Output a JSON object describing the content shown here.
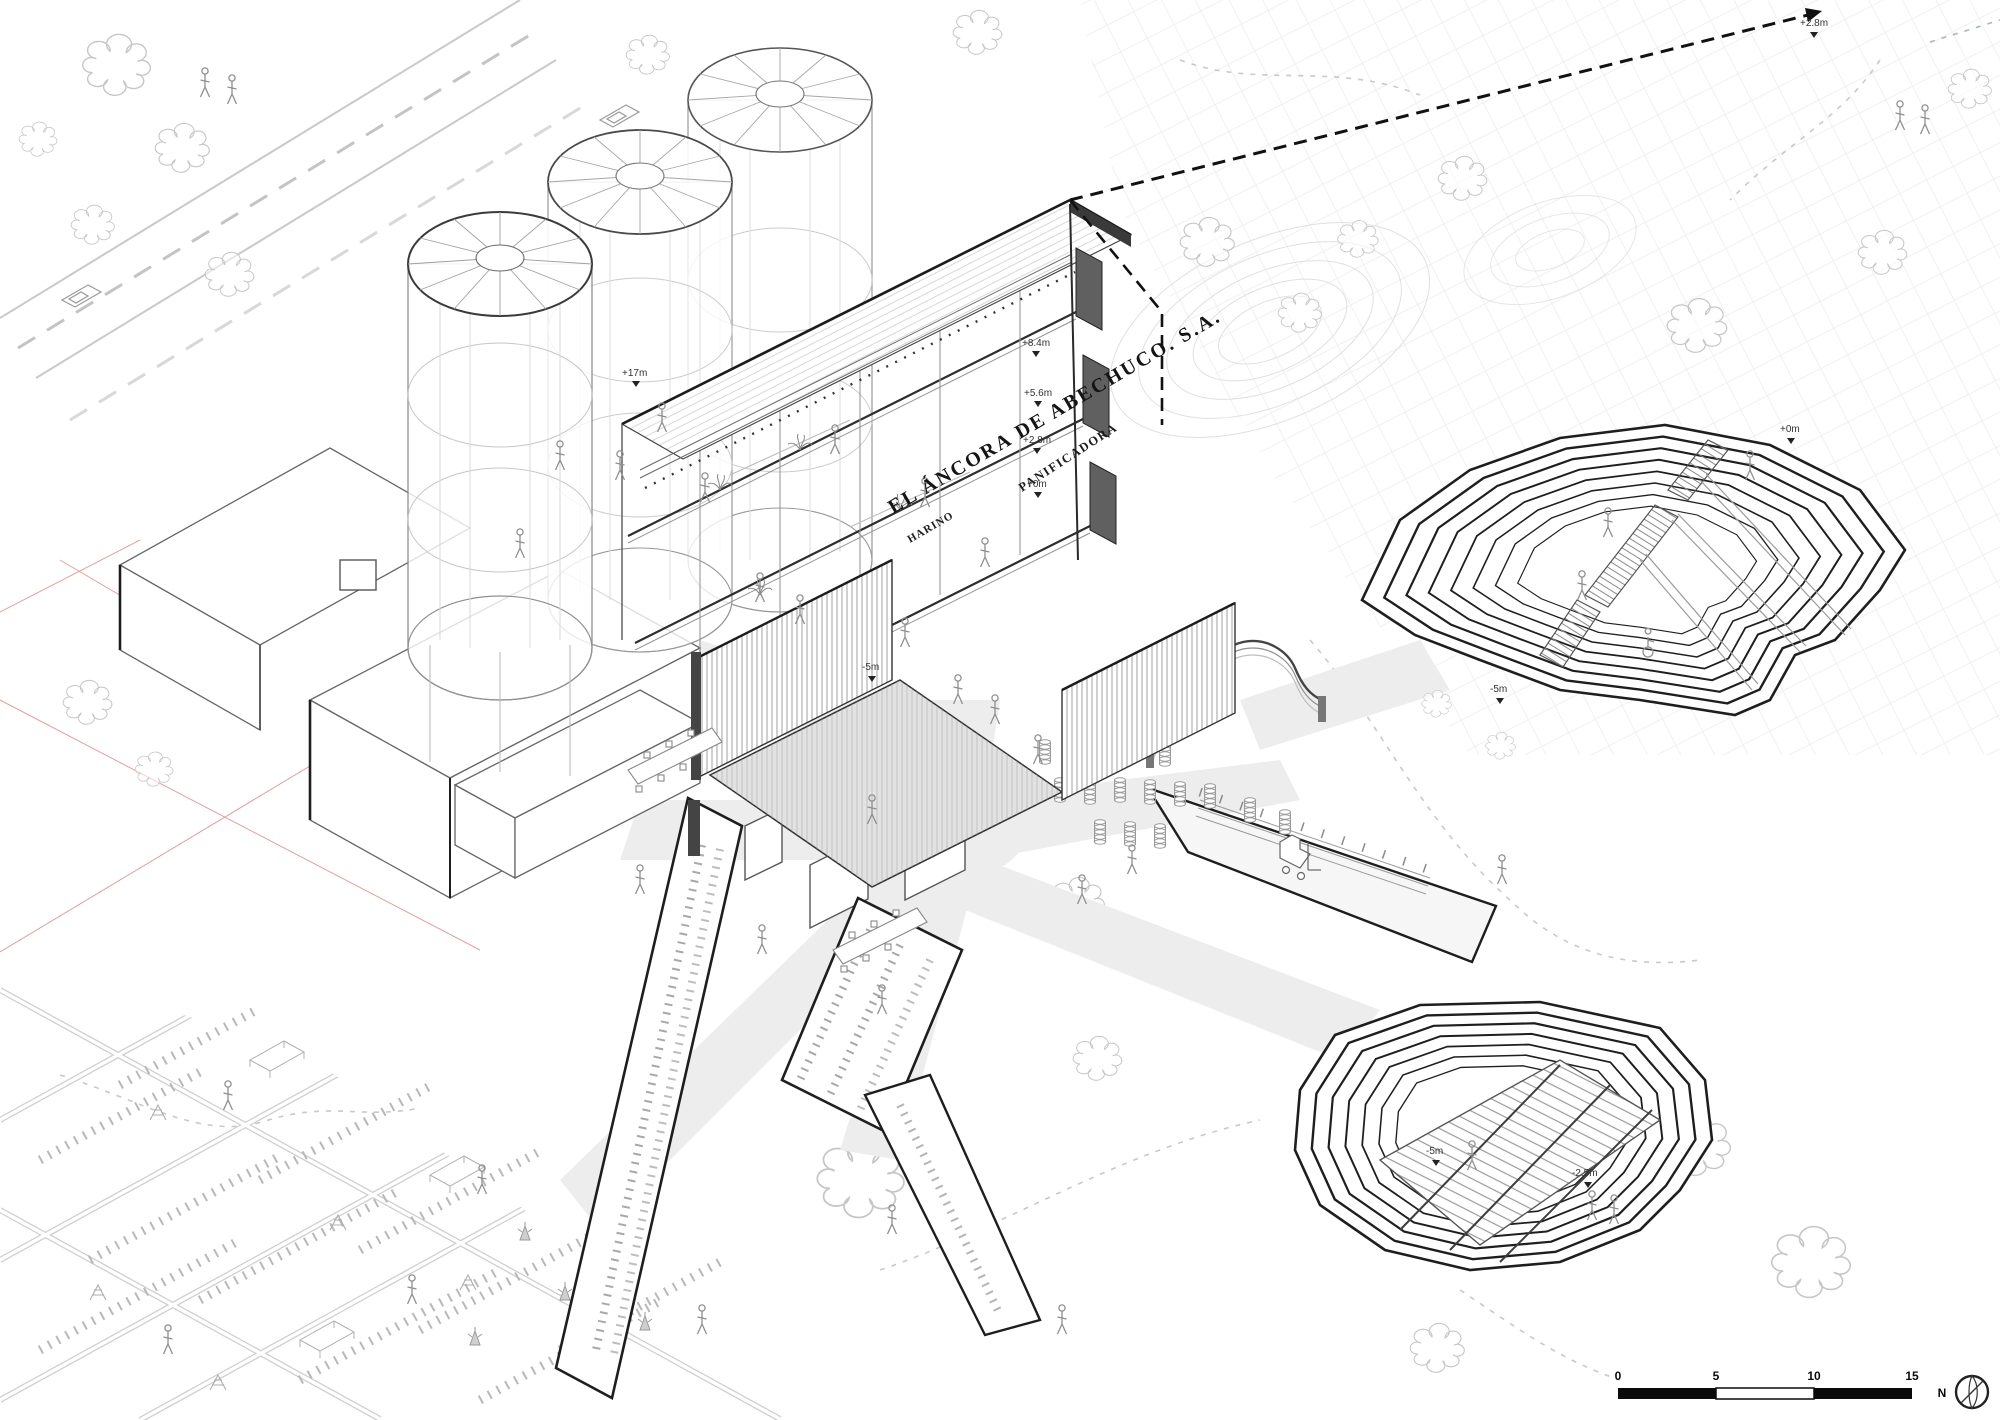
{
  "drawing": {
    "title": "EL ÁNCORA DE ABECHUCO. S.A.",
    "building_labels": {
      "panificadora": "PANIFICADORA",
      "harino": "HARINO"
    },
    "level_markers": [
      "+17m",
      "+8.4m",
      "+5.6m",
      "+2.8m",
      "+0m",
      "+2.8m",
      "+0m",
      "-5m",
      "-5m",
      "-5m",
      "-2.5m"
    ],
    "scale_bar": {
      "ticks": [
        "0",
        "5",
        "10",
        "15"
      ]
    },
    "compass": {
      "north_label": "N"
    },
    "colors": {
      "paper": "#ffffff",
      "ink": "#1a1a1a",
      "medium_line": "#8f8f8f",
      "light_line": "#c4c4c4",
      "faint_line": "#e2e2e2",
      "plaza_path": "#ededed",
      "poche": "#5f5f5f",
      "red_guides": "#e2a0a0"
    }
  }
}
